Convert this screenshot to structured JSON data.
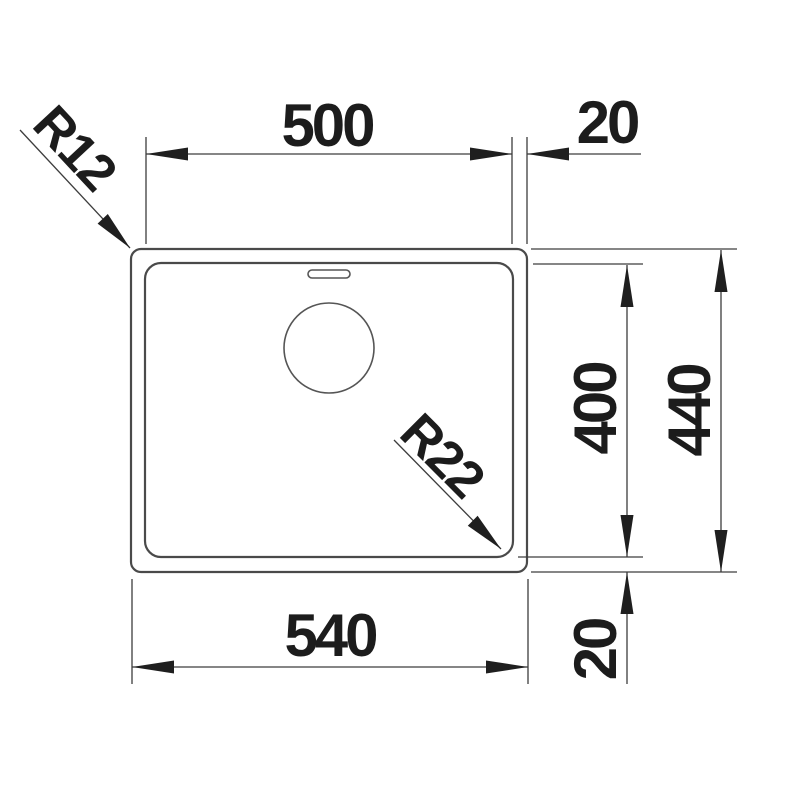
{
  "drawing": {
    "title": "sink-top-view-dimension-drawing",
    "labels": {
      "inner_width": "500",
      "rim_right": "20",
      "radius_outer_corner": "R12",
      "radius_inner_corner": "R22",
      "inner_height": "400",
      "outer_height": "440",
      "outer_width": "540",
      "rim_bottom": "20"
    },
    "colors": {
      "background": "#ffffff",
      "outline": "#4a4a4a",
      "dimension_line": "#3d3d3d",
      "text": "#1c1c1c",
      "arrow": "#1f1f1f"
    }
  }
}
